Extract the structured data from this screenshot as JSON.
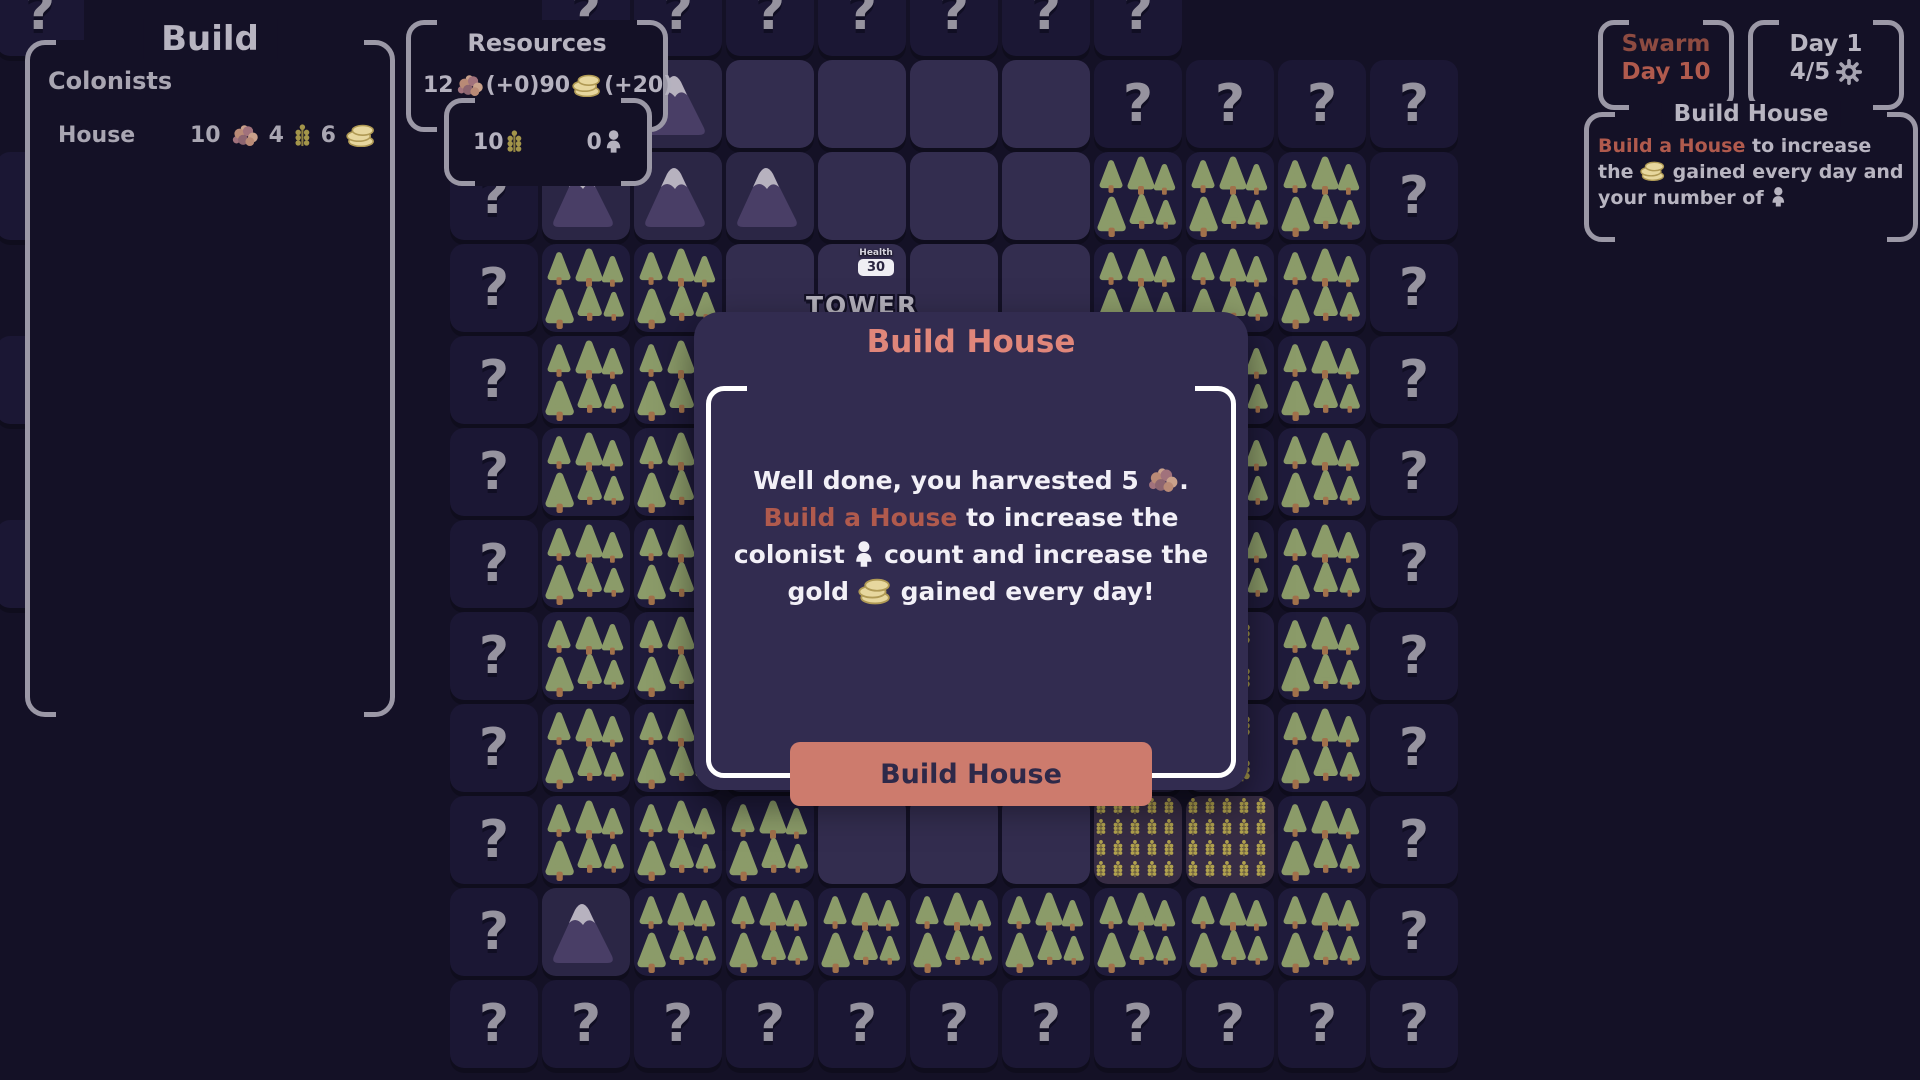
{
  "build_panel": {
    "title": "Build",
    "section_label": "Colonists",
    "items": [
      {
        "name": "House",
        "costs": [
          {
            "amount": "10",
            "icon": "berries"
          },
          {
            "amount": "4",
            "icon": "wheat"
          },
          {
            "amount": "6",
            "icon": "coins"
          }
        ]
      }
    ]
  },
  "resources_panel": {
    "title": "Resources",
    "row1": [
      {
        "amount": "12",
        "icon": "berries",
        "delta": " (+0)"
      },
      {
        "amount": "90",
        "icon": "coins",
        "delta": " (+20)"
      }
    ],
    "row2": [
      {
        "amount": "10",
        "icon": "wheat"
      },
      {
        "amount": "0",
        "icon": "person"
      }
    ]
  },
  "swarm_panel": {
    "title": "Swarm",
    "subtitle": "Day 10"
  },
  "day_panel": {
    "title": "Day 1",
    "progress": "4/5",
    "settings_icon": "gear"
  },
  "info_panel": {
    "title": "Build House",
    "body_segments": [
      {
        "text": "Build a House",
        "style": "accent"
      },
      {
        "text": " to increase the ",
        "style": "normal"
      },
      {
        "icon": "coins"
      },
      {
        "text": " gained every day and your number of ",
        "style": "normal"
      },
      {
        "icon": "person"
      }
    ]
  },
  "modal": {
    "title": "Build House",
    "body_lines": [
      [
        {
          "text": "Well done, you harvested 5 "
        },
        {
          "icon": "berries"
        },
        {
          "text": "."
        }
      ],
      [
        {
          "text": "Build a House",
          "style": "accent"
        },
        {
          "text": " to increase the"
        }
      ],
      [
        {
          "text": "colonist "
        },
        {
          "icon": "person"
        },
        {
          "text": " count and increase the"
        }
      ],
      [
        {
          "text": "gold "
        },
        {
          "icon": "coins"
        },
        {
          "text": " gained every day!"
        }
      ]
    ],
    "button_label": "Build House"
  },
  "tower": {
    "label": "TOWER",
    "health_label": "Health",
    "health_value": "30"
  },
  "grid": {
    "question_glyph": "?",
    "legend": {
      ".": "none",
      "U": "unknown",
      "M": "mountain",
      "F": "forest",
      "E": "cleared",
      "W": "wheat",
      "D": "wheat-field",
      "T": "tower"
    },
    "rows": [
      ".UUUUUUU...",
      ".MMEEEEUUUU",
      "UMMMEEEFFFU",
      "UFFETEEFFFU",
      "UFFEEEEFFFU",
      "UFFEEEEEFFU",
      "UFFEEEEEFFU",
      "UFFEEEEWWFU",
      "UFFFEEEWWFU",
      "UFFFEEEDDFU",
      "UMFFFFFFFFU",
      "UUUUUUUUUUU"
    ],
    "edge_fragment_rows": [
      0,
      2,
      4,
      6
    ]
  },
  "colors": {
    "page_bg": "#141126",
    "panel_border": "#9b98a6",
    "panel_text": "#b8b5c1",
    "accent_red": "#b05a4d",
    "swarm_dark_red": "#8e4b41",
    "modal_bg": "#322c50",
    "modal_title": "#e0867a",
    "button_bg": "#cd7b6d",
    "button_text": "#2e2949",
    "question_mark": "#96939f",
    "mountain_body": "#493e66",
    "mountain_snow": "#b7b2bf",
    "tree_canopy": "#8b9b69",
    "tree_trunk": "#a1714b",
    "wheat_gold": "#a3954a",
    "wheat_field_gold": "#b1a24e",
    "coin_fill": "#e7d79e",
    "coin_edge": "#b09a55",
    "berry_1": "#b98a76",
    "berry_2": "#a1727c",
    "berry_3": "#c9a18b",
    "berry_4": "#8d6570"
  }
}
